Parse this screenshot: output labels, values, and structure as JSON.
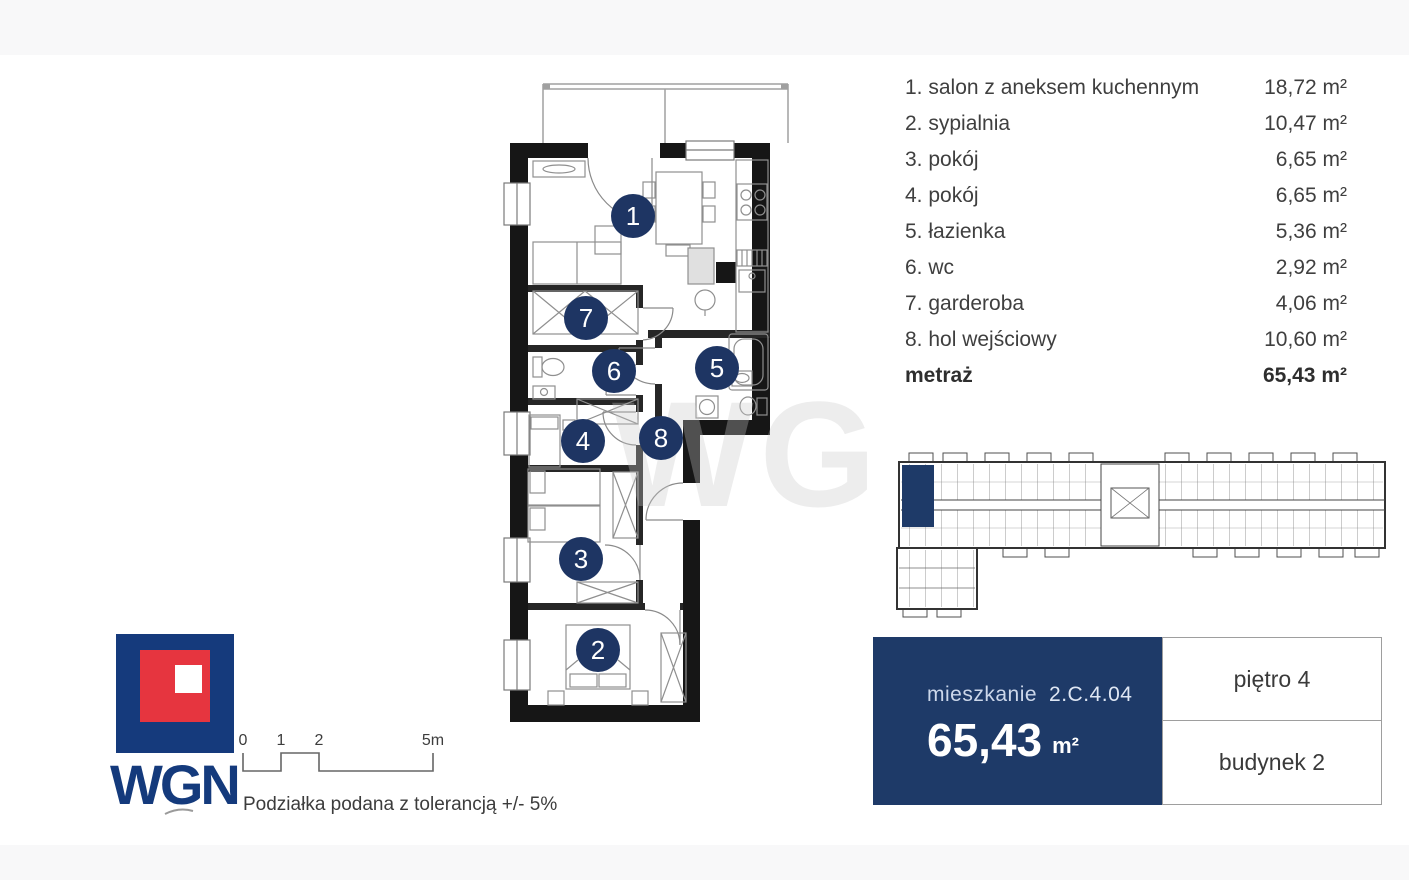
{
  "legend": {
    "rows": [
      {
        "label": "1. salon z aneksem kuchennym",
        "area": "18,72 m²"
      },
      {
        "label": "2. sypialnia",
        "area": "10,47 m²"
      },
      {
        "label": "3. pokój",
        "area": "6,65 m²"
      },
      {
        "label": "4. pokój",
        "area": "6,65 m²"
      },
      {
        "label": "5. łazienka",
        "area": "5,36 m²"
      },
      {
        "label": "6. wc",
        "area": "2,92 m²"
      },
      {
        "label": "7. garderoba",
        "area": "4,06 m²"
      },
      {
        "label": "8. hol wejściowy",
        "area": "10,60 m²"
      }
    ],
    "total": {
      "label": "metraż",
      "area": "65,43 m²"
    }
  },
  "floor_plan": {
    "rooms": [
      "1",
      "2",
      "3",
      "4",
      "5",
      "6",
      "7",
      "8"
    ]
  },
  "unit_card": {
    "label_prefix": "mieszkanie",
    "unit_id": "2.C.4.04",
    "area_value": "65,43",
    "area_unit": "m²"
  },
  "info": {
    "floor": "piętro 4",
    "building": "budynek 2"
  },
  "logo": {
    "text": "WGN"
  },
  "scale": {
    "ticks": [
      "0",
      "1",
      "2",
      "5m"
    ],
    "note": "Podziałka podana z tolerancją +/- 5%"
  },
  "watermark": "WG",
  "colors": {
    "accent_navy": "#1e3563",
    "card_navy": "#1e3a68",
    "logo_blue": "#153a7c",
    "logo_red": "#e6353f",
    "wall_black": "#161616"
  }
}
